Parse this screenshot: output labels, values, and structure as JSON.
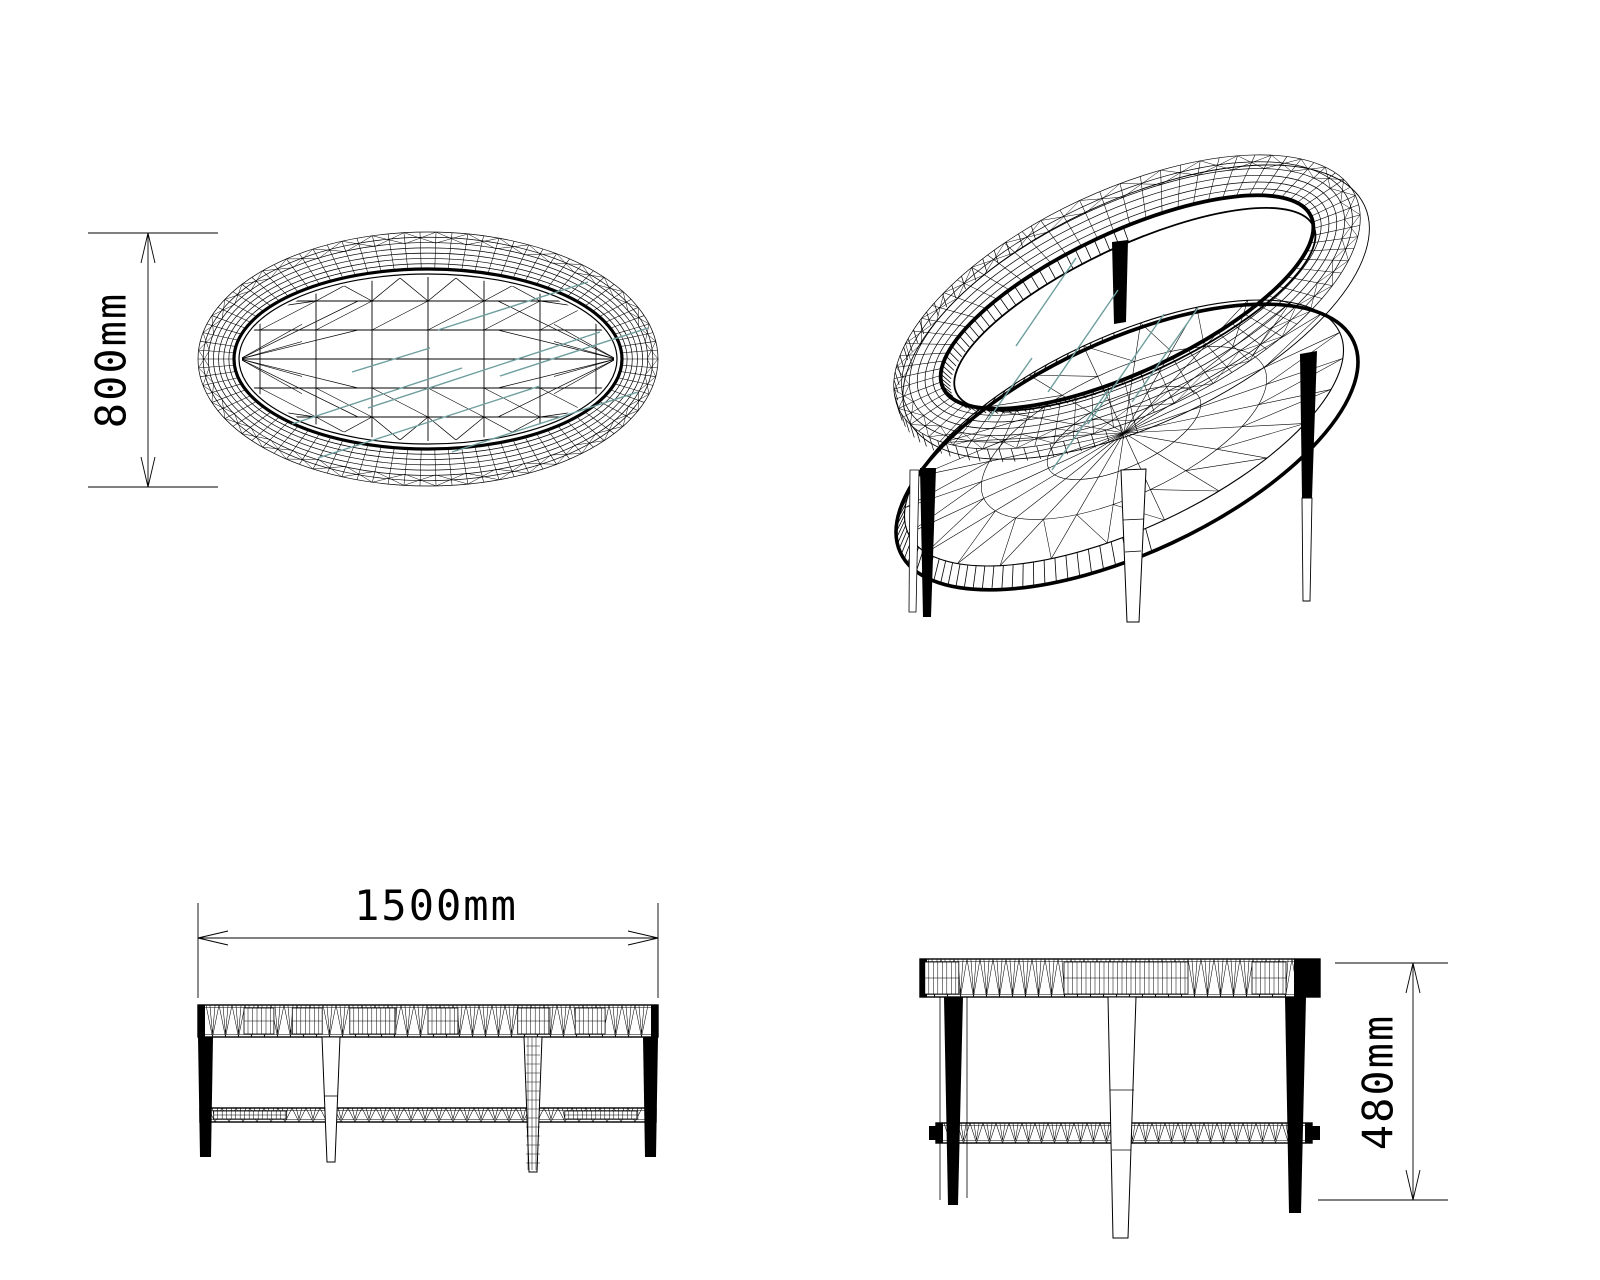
{
  "sheet": {
    "background": "#ffffff"
  },
  "colors": {
    "line": "#000000",
    "glass_hatch": "#6E9E9E",
    "leg_fill": "#000000",
    "paper": "#ffffff"
  },
  "dimensions": {
    "top_width": {
      "label": "800mm",
      "value_mm": 800,
      "orientation": "vertical-rotated"
    },
    "front_length": {
      "label": "1500mm",
      "value_mm": 1500,
      "orientation": "horizontal"
    },
    "side_height": {
      "label": "480mm",
      "value_mm": 480,
      "orientation": "vertical-rotated"
    }
  }
}
